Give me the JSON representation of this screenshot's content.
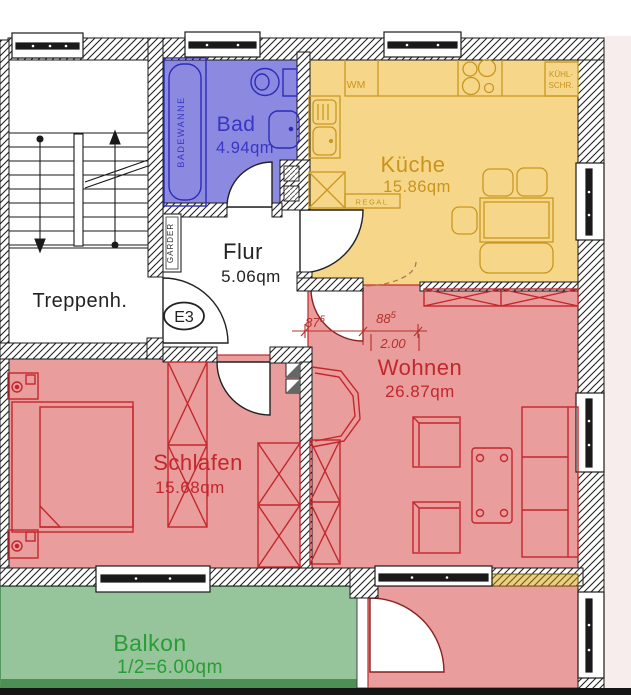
{
  "title": "Wohnung Grundriss E3",
  "rooms": {
    "treppenhaus": {
      "label": "Treppenh."
    },
    "bad": {
      "label": "Bad",
      "area": "4.94qm"
    },
    "kueche": {
      "label": "Küche",
      "area": "15.86qm"
    },
    "flur": {
      "label": "Flur",
      "area": "5.06qm"
    },
    "wohnen": {
      "label": "Wohnen",
      "area": "26.87qm"
    },
    "schlafen": {
      "label": "Schlafen",
      "area": "15.68qm"
    },
    "balkon": {
      "label": "Balkon",
      "area": "1/2=6.00qm"
    }
  },
  "entrance": {
    "label": "E3"
  },
  "fixtures": {
    "badewanne": "BADEWANNE",
    "waschmaschine": "WM",
    "kuehlschrank_line1": "KÜHL-",
    "kuehlschrank_line2": "SCHR.",
    "regal": "REGAL",
    "garderobe": "GARDER"
  },
  "dimensions": {
    "door_width_1": "87",
    "door_width_1_sup": "5",
    "door_width_2": "88",
    "door_width_2_sup": "5",
    "lintel_height": "2.00"
  },
  "colors": {
    "bath_fill": "#8b8ae0",
    "bath_line": "#2d2bb8",
    "bath_text": "#3a35c5",
    "kitchen_fill": "#f6d78a",
    "kitchen_line": "#c9971f",
    "kitchen_text": "#c9931d",
    "living_fill": "#e99d9d",
    "living_line": "#c2272c",
    "living_text": "#c2272c",
    "balcony_fill": "#96c59b",
    "balcony_dark": "#4d8f55",
    "balcony_text": "#2a9c35",
    "wall_line": "#1a1a1a",
    "black_text": "#222222",
    "dim_color": "#b5302c",
    "margin_pink": "#f7edec"
  }
}
